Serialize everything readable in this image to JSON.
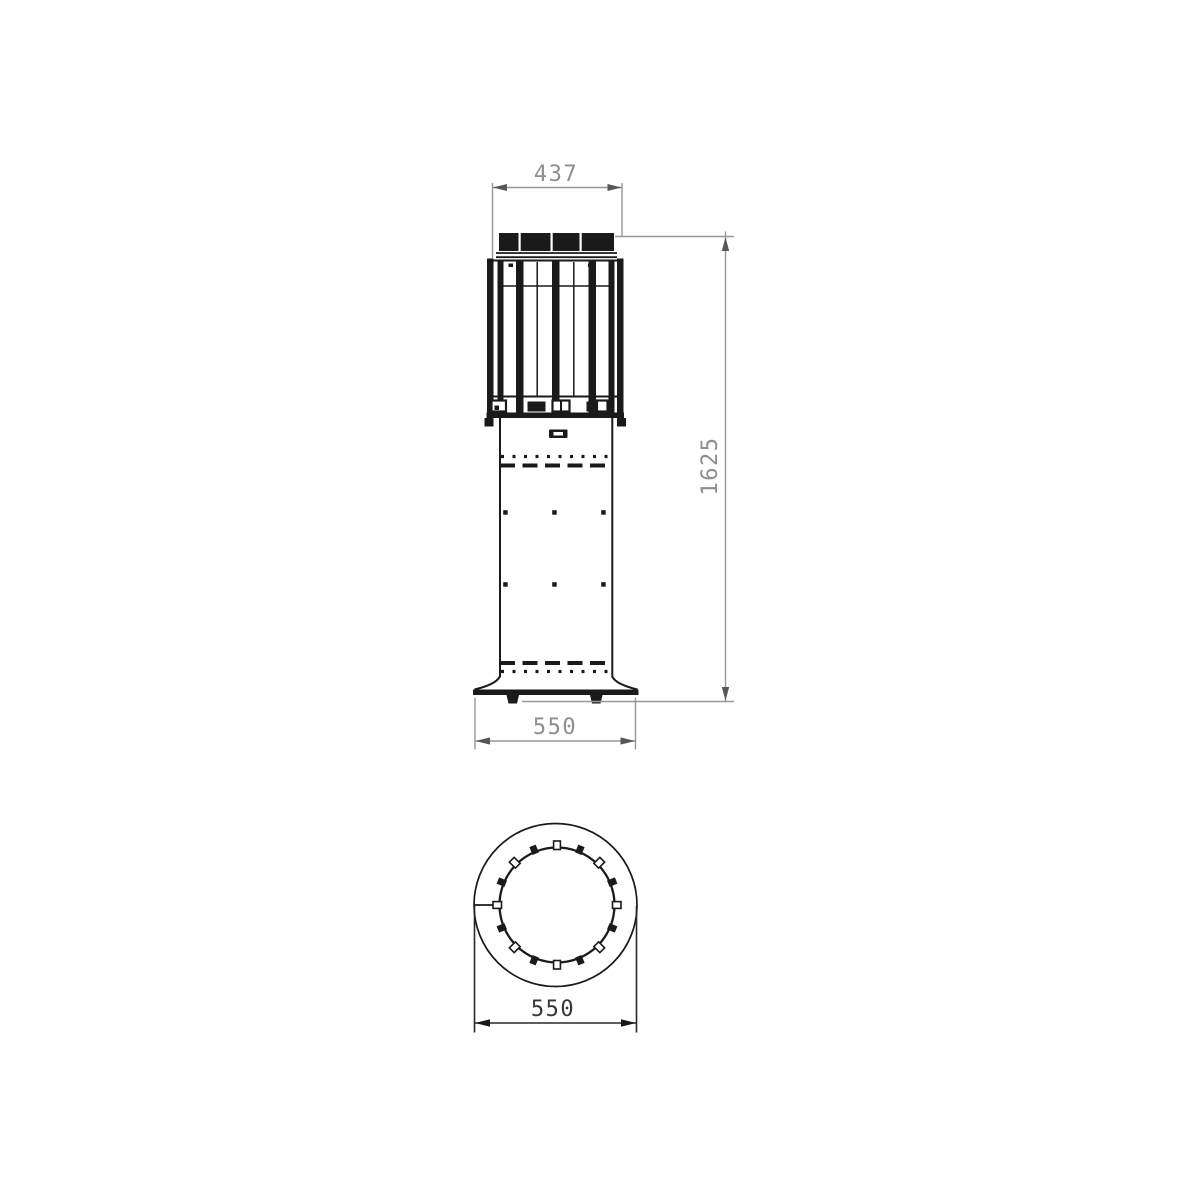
{
  "drawing": {
    "type": "technical-dimension-drawing",
    "views": {
      "front": {
        "dimensions": {
          "top_width": "437",
          "overall_height": "1625",
          "base_width": "550"
        }
      },
      "plan": {
        "dimensions": {
          "outer_diameter": "550"
        }
      }
    },
    "colors": {
      "line_black": "#1a1a1a",
      "dim_gray_line": "#95989c",
      "dim_gray_text": "#8b8e93",
      "dim_gray_arrow": "#55575a",
      "dim_dark_line": "#26282c",
      "dim_dark_text": "#33363b",
      "background": "#ffffff"
    }
  }
}
